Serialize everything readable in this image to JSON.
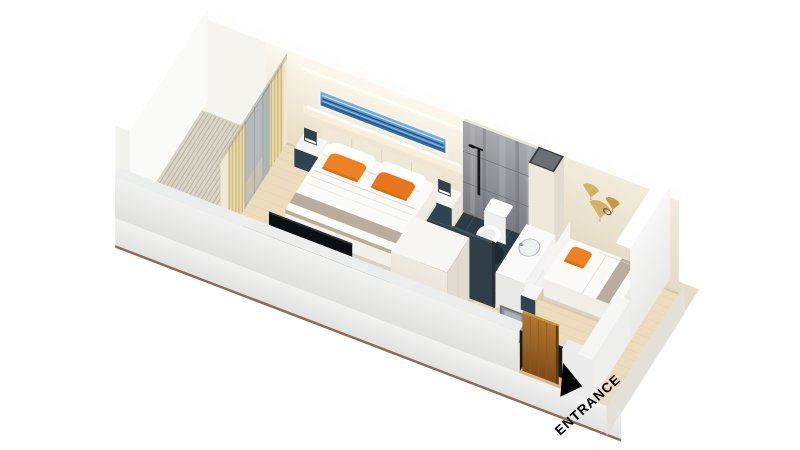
{
  "title": "Hotel room 3D isometric floor plan",
  "entrance": {
    "label": "ENTRANCE"
  },
  "legend": {
    "rooms": [
      "balcony",
      "bedroom",
      "bathroom",
      "second-bedroom",
      "entrance-corridor"
    ],
    "furniture": [
      "double-bed",
      "single-bed",
      "nightstands",
      "tv-cabinet",
      "tv",
      "wardrobe",
      "vanity-sink",
      "toilet",
      "shower",
      "curtains",
      "entrance-door",
      "wall-art-blue",
      "wall-art-gold"
    ]
  },
  "colors": {
    "bg": "#ffffff",
    "slab_top": "#e7dbc4",
    "slab_face_a": "#f4f3f1",
    "slab_face_b": "#ddd9d3",
    "slab_edge_line": "#8d6b59",
    "slab_right": "#e3e0da",
    "deck": "#d9d4c6",
    "deck_line": "#b1ab9c",
    "wood": "#ecdcbd",
    "plank": "#d8c49e",
    "bath_floor": "#2c3b48",
    "grout": "#46586a",
    "wall_white": "#fafaf8",
    "wall_top": "#fdfdfc",
    "wall_cream_a": "#fcf8ee",
    "wall_cream_b": "#e7ddc5",
    "wall_second_a": "#f2ecdd",
    "wall_second_b": "#e4dac4",
    "wall_balcony": "#f6f4ee",
    "front_wall_a": "#f2f2f0",
    "front_wall_b": "#e0e0de",
    "front_wall_top": "#eceded",
    "marble_a": "#a7abae",
    "marble_b": "#787d82",
    "marble_streak_light": "#c6c9cb",
    "marble_streak_dark": "#565b60",
    "led": "#ffffff",
    "led_halo": "#fff8e0",
    "art_frame": "#f7f4ec",
    "art_blue_a": "#7db3e0",
    "art_blue_b": "#2f6ba6",
    "art_blue_dark": "#1d4f85",
    "art_blue_light": "#cfe6f7",
    "gold": "#d3b36a",
    "gold_dark": "#c19a43",
    "ring": "#5c6066",
    "curtain": "#e9d9a9",
    "curtain_dark": "#d3bb80",
    "curtain_base": "#efe8d6",
    "sheer_gray": "#a9b0b5",
    "glass": "#aeb4b6",
    "glass_frame": "#8a9194",
    "rail": "#c4c4c2",
    "headboard": "#efe8d7",
    "headboard_seam": "#ddd3bb",
    "mattress": "#fbfaf6",
    "duvet_crease": "#ddd5c6",
    "runner": "#b9ae9e",
    "pillow_white": "#ffffff",
    "pillow_edge": "#d8d2c6",
    "orange": "#ee8124",
    "orange_deep": "#d06c12",
    "nightstand_dark": "#2f4350",
    "lamp_dark": "#33414b",
    "lamp_glow": "#fdfdf5",
    "teal_top": "#3f5862",
    "teal_side": "#2c4049",
    "tv_black": "#0c0f12",
    "tv_sheen": "#2a3238",
    "appliance": "#22262a",
    "steel": "#c6cbcf",
    "red_dot": "#cc2a1f",
    "wardrobe_top": "#f8f6f2",
    "wardrobe_front": "#efeae2",
    "wardrobe_side": "#e2dbd0",
    "partition_dark": "#2f3e49",
    "shaft_top": "#3a3f45",
    "toilet_white": "#fbfcfc",
    "toilet_inner": "#e9edee",
    "vanity_white": "#f2f2f0",
    "sink": "#eef1f2",
    "sink_rim": "#b5bcc0",
    "mirror_frame": "#6d757c",
    "mirror_face": "#8e979e",
    "mirror_inner": "#aab2b8",
    "door_a": "#b5762f",
    "door_b": "#7d4b18",
    "door_grain": "#8f5a20",
    "door_edge": "#5f3910",
    "door_top": "#c8913f",
    "threshold": "#d9b98c",
    "gap_dark": "#17191c",
    "shadow_warm": "#c9b895",
    "shadow_cool": "#16222c",
    "fixture_black": "#14171a",
    "label_black": "#000000"
  }
}
